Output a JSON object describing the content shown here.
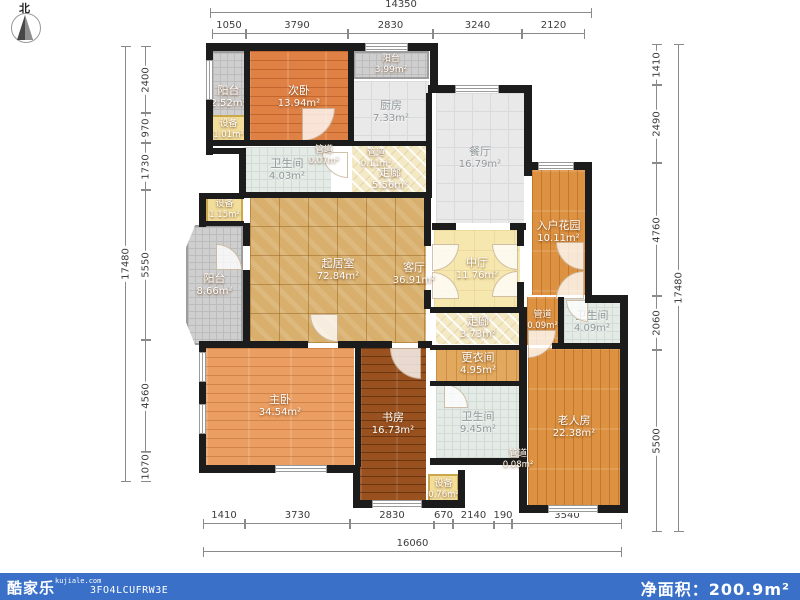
{
  "compass": {
    "north_label": "北"
  },
  "dims": {
    "top_total": "14350",
    "top": [
      "1050",
      "3790",
      "2830",
      "3240",
      "2120"
    ],
    "left_total": "17480",
    "left": [
      "2400",
      "970",
      "1730",
      "5550",
      "4560",
      "1070"
    ],
    "right_total": "17480",
    "right": [
      "1410",
      "2490",
      "4760",
      "2060",
      "5500"
    ],
    "bottom_total": "16060",
    "bottom": [
      "1410",
      "3730",
      "2830",
      "670",
      "2140",
      "190",
      "3540"
    ]
  },
  "rooms": {
    "balcony2": {
      "name": "阳台",
      "area": "2.52m²"
    },
    "bedroom2": {
      "name": "次卧",
      "area": "13.94m²"
    },
    "balcony3": {
      "name": "阳台",
      "area": "3.99m²"
    },
    "kitchen": {
      "name": "厨房",
      "area": "7.33m²"
    },
    "equip1": {
      "name": "设备",
      "area": "1.01m²"
    },
    "pipe1": {
      "name": "管道",
      "area": "0.07m²"
    },
    "pipe2": {
      "name": "管道",
      "area": "0.11m²"
    },
    "bath1": {
      "name": "卫生间",
      "area": "4.03m²"
    },
    "corridor1": {
      "name": "走廊",
      "area": "5.56m²"
    },
    "dining": {
      "name": "餐厅",
      "area": "16.79m²"
    },
    "equip2": {
      "name": "设备",
      "area": "1.15m²"
    },
    "balcony1": {
      "name": "阳台",
      "area": "8.66m²"
    },
    "living": {
      "name": "起居室",
      "area": "72.84m²"
    },
    "guest": {
      "name": "客厅",
      "area": "36.91m²"
    },
    "midhall": {
      "name": "中厅",
      "area": "11.76m²"
    },
    "garden": {
      "name": "入户花园",
      "area": "10.11m²"
    },
    "pipe3": {
      "name": "管道",
      "area": "0.09m²"
    },
    "bath2": {
      "name": "卫生间",
      "area": "4.09m²"
    },
    "corridor2": {
      "name": "走廊",
      "area": "3.73m²"
    },
    "dressing": {
      "name": "更衣间",
      "area": "4.95m²"
    },
    "bath3": {
      "name": "卫生间",
      "area": "9.45m²"
    },
    "master": {
      "name": "主卧",
      "area": "34.54m²"
    },
    "study": {
      "name": "书房",
      "area": "16.73m²"
    },
    "equip3": {
      "name": "设备",
      "area": "0.76m²"
    },
    "pipe4": {
      "name": "管道",
      "area": "0.08m²"
    },
    "elder": {
      "name": "老人房",
      "area": "22.38m²"
    }
  },
  "footer": {
    "logo": "酷家乐",
    "site": "kujiale.com",
    "code": "3FO4LCUFRW3E",
    "net_area_label": "净面积：",
    "net_area_value": "200.9m²",
    "bar_color": "#3a70c8"
  }
}
